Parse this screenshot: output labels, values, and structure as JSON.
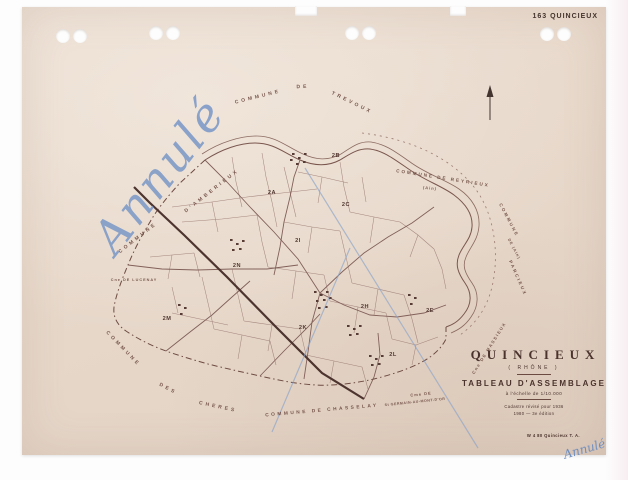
{
  "document": {
    "archive_ref": "163 QUINCIEUX",
    "imprint": "W 4 80 Quincieux T. A."
  },
  "annotations": {
    "cancelled_large": "Annulé",
    "cancelled_small": "Annulé"
  },
  "title_block": {
    "commune": "QUINCIEUX",
    "department": "( RHÔNE )",
    "doc_type": "TABLEAU D'ASSEMBLAGE",
    "scale": "à l'échelle de 1/10.000",
    "revision": "Cadastre révisé pour 1936",
    "edition": "1980 — 3e édition"
  },
  "map": {
    "north_arrow": "north-arrow",
    "labels": [
      {
        "id": "trevoux-1",
        "text": "COMMUNE",
        "x": 236,
        "y": 90,
        "rot": -14,
        "fs": 5,
        "ls": 3
      },
      {
        "id": "trevoux-2",
        "text": "DE",
        "x": 281,
        "y": 80,
        "rot": -2,
        "fs": 5,
        "ls": 3
      },
      {
        "id": "trevoux-3",
        "text": "TREVOUX",
        "x": 330,
        "y": 96,
        "rot": 26,
        "fs": 5,
        "ls": 3
      },
      {
        "id": "reyrieux",
        "text": "COMMUNE DE REYRIEUX",
        "x": 421,
        "y": 171,
        "rot": 9,
        "fs": 4.6,
        "ls": 2
      },
      {
        "id": "reyrieux-ain",
        "text": "(Ain)",
        "x": 408,
        "y": 181,
        "rot": 6,
        "fs": 4,
        "ls": 1
      },
      {
        "id": "amberieux-1",
        "text": "COMMUNE",
        "x": 116,
        "y": 231,
        "rot": -38,
        "fs": 5,
        "ls": 3
      },
      {
        "id": "amberieux-2",
        "text": "D'AMBERIEUX",
        "x": 190,
        "y": 184,
        "rot": -38,
        "fs": 5,
        "ls": 3
      },
      {
        "id": "lucenay",
        "text": "Cne DE LUCENAY",
        "x": 112,
        "y": 273,
        "rot": 0,
        "fs": 3.8,
        "ls": 1
      },
      {
        "id": "cheres-1",
        "text": "COMMUNE",
        "x": 101,
        "y": 342,
        "rot": 46,
        "fs": 5,
        "ls": 3
      },
      {
        "id": "cheres-2",
        "text": "DES",
        "x": 146,
        "y": 382,
        "rot": 28,
        "fs": 5,
        "ls": 3
      },
      {
        "id": "cheres-3",
        "text": "CHERES",
        "x": 196,
        "y": 400,
        "rot": 12,
        "fs": 5,
        "ls": 3
      },
      {
        "id": "chasselay",
        "text": "COMMUNE DE CHASSELAY",
        "x": 300,
        "y": 404,
        "rot": -5,
        "fs": 4.8,
        "ls": 2.5
      },
      {
        "id": "stgermain-1",
        "text": "Cme DE",
        "x": 399,
        "y": 387,
        "rot": -6,
        "fs": 4,
        "ls": 1
      },
      {
        "id": "stgermain-2",
        "text": "St GERMAIN-AU-MONT-D'OR",
        "x": 393,
        "y": 395,
        "rot": -6,
        "fs": 3.6,
        "ls": 0.5
      },
      {
        "id": "parcieux-1",
        "text": "COMMUNE",
        "x": 487,
        "y": 213,
        "rot": 62,
        "fs": 4.4,
        "ls": 2
      },
      {
        "id": "parcieux-2",
        "text": "DE (Ain)",
        "x": 492,
        "y": 242,
        "rot": 62,
        "fs": 3.8,
        "ls": 1
      },
      {
        "id": "parcieux-3",
        "text": "PARCIEUX",
        "x": 496,
        "y": 271,
        "rot": 66,
        "fs": 4.4,
        "ls": 2
      },
      {
        "id": "massieux",
        "text": "Cne DE MASSIEUX",
        "x": 467,
        "y": 341,
        "rot": -58,
        "fs": 4.2,
        "ls": 1.5
      },
      {
        "id": "sec-2b",
        "cls": "section",
        "text": "2B",
        "x": 314,
        "y": 149,
        "fs": 5.6,
        "ls": 0.5
      },
      {
        "id": "sec-2a",
        "cls": "section",
        "text": "2A",
        "x": 250,
        "y": 186,
        "fs": 5.6,
        "ls": 0.5
      },
      {
        "id": "sec-2c",
        "cls": "section",
        "text": "2C",
        "x": 324,
        "y": 198,
        "fs": 5.6,
        "ls": 0.5
      },
      {
        "id": "sec-2i",
        "cls": "section",
        "text": "2I",
        "x": 276,
        "y": 234,
        "fs": 5.6,
        "ls": 0.5
      },
      {
        "id": "sec-2n",
        "cls": "section",
        "text": "2N",
        "x": 215,
        "y": 259,
        "fs": 5.6,
        "ls": 0.5
      },
      {
        "id": "sec-2h",
        "cls": "section",
        "text": "2H",
        "x": 343,
        "y": 300,
        "fs": 5.6,
        "ls": 0.5
      },
      {
        "id": "sec-2e",
        "cls": "section",
        "text": "2E",
        "x": 408,
        "y": 304,
        "fs": 5.6,
        "ls": 0.5
      },
      {
        "id": "sec-2m",
        "cls": "section",
        "text": "2M",
        "x": 145,
        "y": 312,
        "fs": 5.6,
        "ls": 0.5
      },
      {
        "id": "sec-2k",
        "cls": "section",
        "text": "2K",
        "x": 281,
        "y": 321,
        "fs": 5.6,
        "ls": 0.5
      },
      {
        "id": "sec-2l",
        "cls": "section",
        "text": "2L",
        "x": 371,
        "y": 348,
        "fs": 5.6,
        "ls": 0.5
      }
    ]
  }
}
